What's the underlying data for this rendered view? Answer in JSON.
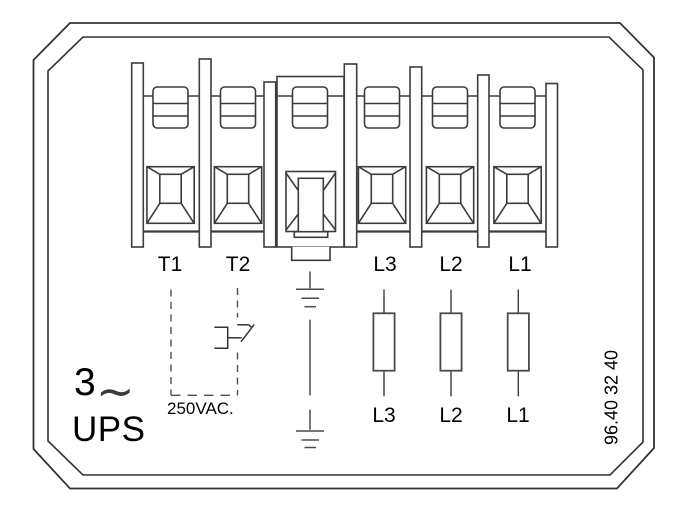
{
  "diagram": {
    "terminals": {
      "t1": "T1",
      "t2": "T2",
      "l3": "L3",
      "l2": "L2",
      "l1": "L1"
    },
    "supply_lines": {
      "l3": "L3",
      "l2": "L2",
      "l1": "L1"
    },
    "contact_rating": "250VAC.",
    "phase": "3",
    "phase_symbol": "∼",
    "system_label": "UPS",
    "part_number": "96.40 32 40"
  },
  "colors": {
    "line": "#3c3c3c",
    "text": "#000000",
    "background": "#ffffff"
  }
}
